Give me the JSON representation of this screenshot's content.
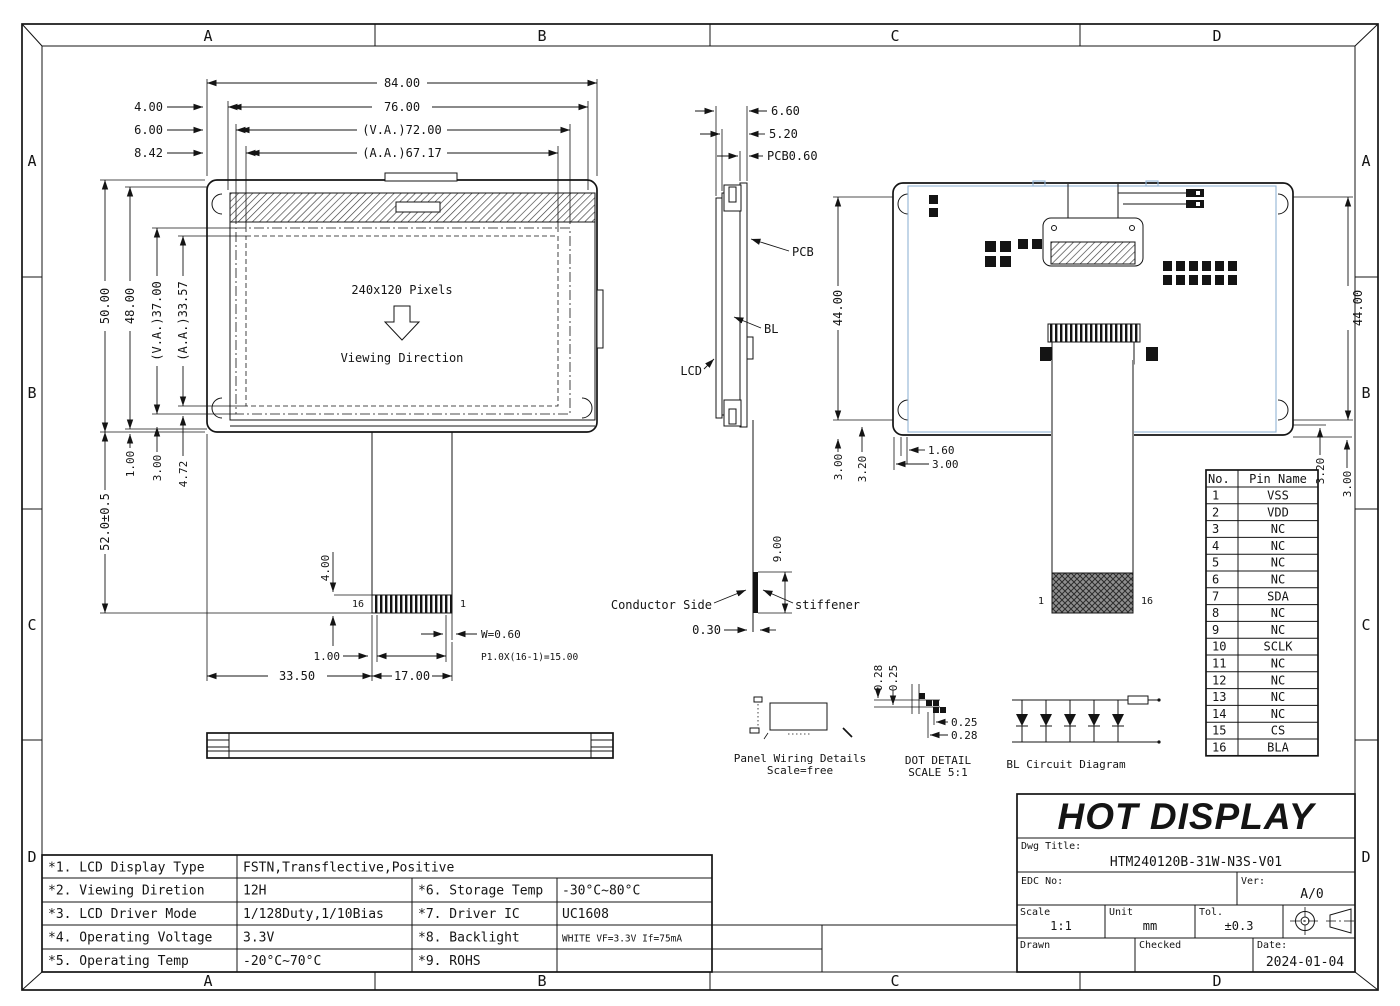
{
  "sheet": {
    "zones": [
      "A",
      "B",
      "C",
      "D"
    ]
  },
  "front": {
    "pixels": "240x120 Pixels",
    "viewing": "Viewing Direction",
    "pin_left": "16",
    "pin_right": "1",
    "d84": "84.00",
    "d76": "76.00",
    "dva72": "(V.A.)72.00",
    "daa67": "(A.A.)67.17",
    "d4": "4.00",
    "d6": "6.00",
    "d842": "8.42",
    "d50": "50.00",
    "d48": "48.00",
    "dva37": "(V.A.)37.00",
    "daa33": "(A.A.)33.57",
    "d1": "1.00",
    "d3": "3.00",
    "d472": "4.72",
    "d52": "52.0±0.5",
    "dfpc4": "4.00",
    "dw": "W=0.60",
    "dpitch": "P1.0X(16-1)=15.00",
    "dfpc1": "1.00",
    "d17": "17.00",
    "d335": "33.50"
  },
  "side": {
    "d66": "6.60",
    "d52": "5.20",
    "dpcb": "PCB0.60",
    "pcb": "PCB",
    "bl": "BL",
    "lcd": "LCD",
    "conductor": "Conductor Side",
    "stiffener": "stiffener",
    "d9": "9.00",
    "d03": "0.30"
  },
  "rear": {
    "d44": "44.00",
    "d3l": "3.00",
    "d32l": "3.20",
    "d16": "1.60",
    "d3b": "3.00",
    "d32r": "3.20",
    "d3r": "3.00",
    "pin1": "1",
    "pin16": "16"
  },
  "pin_table": {
    "h_no": "No.",
    "h_name": "Pin Name",
    "rows": [
      {
        "no": "1",
        "name": "VSS"
      },
      {
        "no": "2",
        "name": "VDD"
      },
      {
        "no": "3",
        "name": "NC"
      },
      {
        "no": "4",
        "name": "NC"
      },
      {
        "no": "5",
        "name": "NC"
      },
      {
        "no": "6",
        "name": "NC"
      },
      {
        "no": "7",
        "name": "SDA"
      },
      {
        "no": "8",
        "name": "NC"
      },
      {
        "no": "9",
        "name": "NC"
      },
      {
        "no": "10",
        "name": "SCLK"
      },
      {
        "no": "11",
        "name": "NC"
      },
      {
        "no": "12",
        "name": "NC"
      },
      {
        "no": "13",
        "name": "NC"
      },
      {
        "no": "14",
        "name": "NC"
      },
      {
        "no": "15",
        "name": "CS"
      },
      {
        "no": "16",
        "name": "BLA"
      }
    ]
  },
  "details": {
    "pw_title": "Panel Wiring Details",
    "pw_scale": "Scale=free",
    "dot_title": "DOT DETAIL",
    "dot_scale": "SCALE 5:1",
    "dot_t1": "0.28",
    "dot_t2": "0.25",
    "dot_r1": "0.25",
    "dot_r2": "0.28",
    "bl_title": "BL Circuit Diagram"
  },
  "spec": {
    "rows": [
      {
        "item": "*1. LCD Display Type",
        "value": "FSTN,Transflective,Positive",
        "item2": "",
        "value2": ""
      },
      {
        "item": "*2. Viewing Diretion",
        "value": "12H",
        "item2": "*6. Storage Temp",
        "value2": "-30°C~80°C"
      },
      {
        "item": "*3. LCD Driver Mode",
        "value": "1/128Duty,1/10Bias",
        "item2": "*7. Driver IC",
        "value2": "UC1608"
      },
      {
        "item": "*4. Operating Voltage",
        "value": "3.3V",
        "item2": "*8. Backlight",
        "value2": "WHITE VF=3.3V If=75mA"
      },
      {
        "item": "*5. Operating Temp",
        "value": "-20°C~70°C",
        "item2": "*9. ROHS",
        "value2": ""
      }
    ]
  },
  "title_block": {
    "company": "HOT DISPLAY",
    "dwg_label": "Dwg Title:",
    "dwg": "HTM240120B-31W-N3S-V01",
    "edc": "EDC No:",
    "ver_label": "Ver:",
    "ver": "A/0",
    "scale_label": "Scale",
    "scale": "1:1",
    "unit_label": "Unit",
    "unit": "mm",
    "tol_label": "Tol.",
    "tol": "±0.3",
    "drawn": "Drawn",
    "checked": "Checked",
    "date_label": "Date:",
    "date": "2024-01-04"
  }
}
